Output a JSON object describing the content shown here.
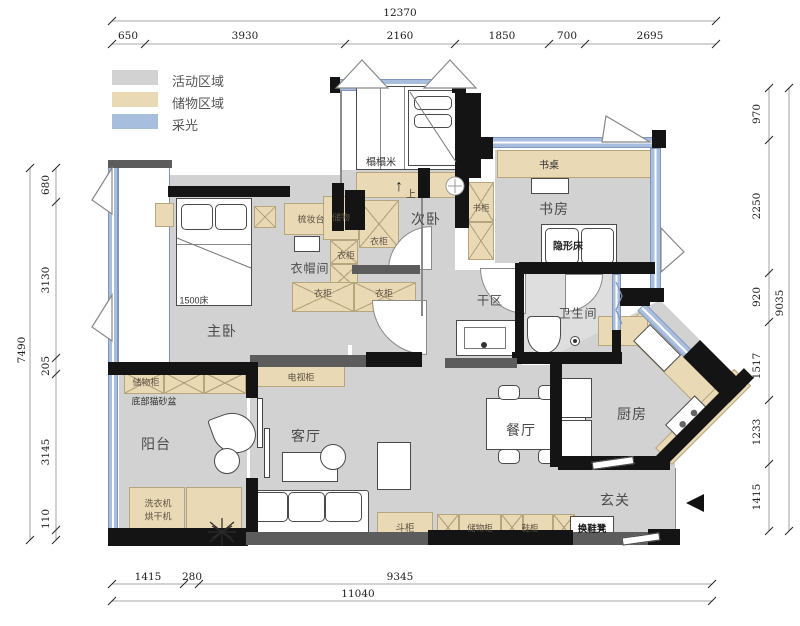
{
  "legend": {
    "activity": {
      "label": "活动区域",
      "color": "#d2d2d2"
    },
    "storage": {
      "label": "储物区域",
      "color": "#e9d9b5"
    },
    "daylight": {
      "label": "采光",
      "color": "#a8bedf"
    }
  },
  "rooms": {
    "master_bedroom": "主卧",
    "second_bedroom": "次卧",
    "study": "书房",
    "cloakroom": "衣帽间",
    "dry_area": "干区",
    "bathroom": "卫生间",
    "kitchen": "厨房",
    "dining": "餐厅",
    "living": "客厅",
    "balcony": "阳台",
    "foyer": "玄关"
  },
  "furniture": {
    "bed_1500": "1500床",
    "tatami": "榻榻米",
    "stairs_up": "上",
    "dressing_table": "梳妆台",
    "storage": "储物",
    "wardrobe": "衣柜",
    "bookcase": "书柜",
    "desk": "书桌",
    "hidden_bed": "隐形床",
    "tv_cabinet": "电视柜",
    "storage_cabinet": "储物柜",
    "cat_litter": "底部猫砂盆",
    "washer": "洗衣机",
    "dryer": "烘干机",
    "chest_drawers": "斗柜",
    "shoe_cabinet": "鞋柜",
    "shoe_bench": "换鞋凳"
  },
  "icons": {
    "up_arrow": "↑"
  },
  "dimensions": {
    "top": {
      "total": "12370",
      "segments": [
        "650",
        "3930",
        "2160",
        "1850",
        "700",
        "2695"
      ]
    },
    "left": {
      "total": "7490",
      "segments": [
        "680",
        "3130",
        "205",
        "3145",
        "110"
      ]
    },
    "right": {
      "total": "9035",
      "segments": [
        "970",
        "2250",
        "920",
        "1517",
        "1233",
        "1415"
      ]
    },
    "bottom": {
      "total": "11040",
      "segments": [
        "1415",
        "280",
        "9345"
      ]
    }
  }
}
